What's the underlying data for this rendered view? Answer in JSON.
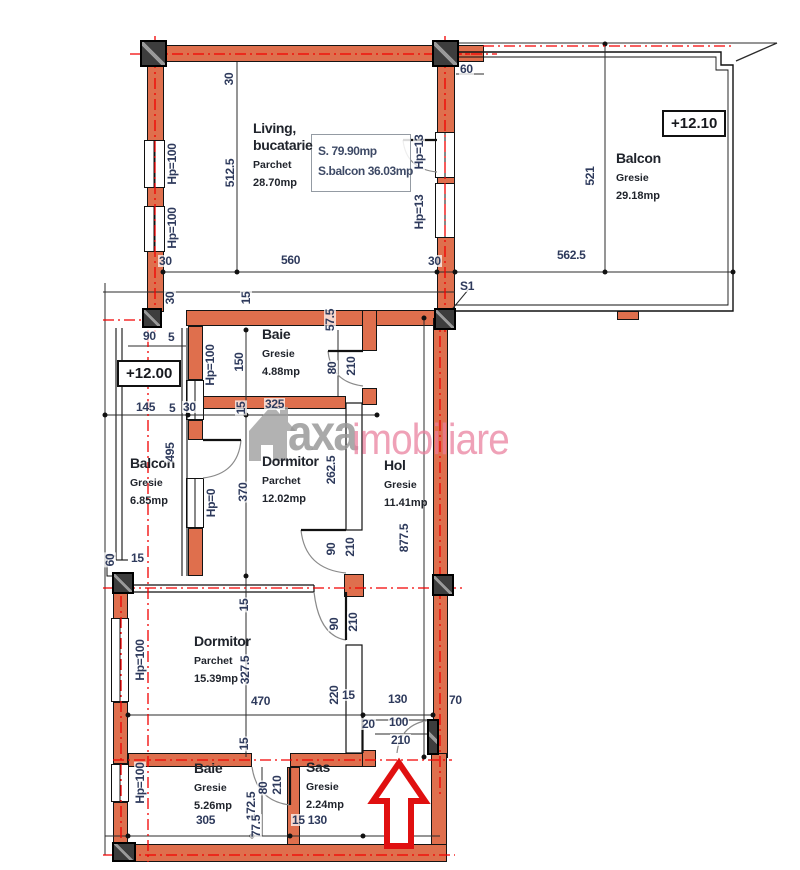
{
  "plan": {
    "watermark": {
      "brand_prefix": "axa",
      "brand_suffix": "imobiliare"
    },
    "info_box": {
      "line1": "S. 79.90mp",
      "line2": "S.balcon 36.03mp"
    },
    "level_markers": [
      {
        "text": "+12.00",
        "x": 117,
        "y": 360
      },
      {
        "text": "+12.10",
        "x": 662,
        "y": 110
      }
    ],
    "rooms": [
      {
        "id": "living",
        "name": "Living,",
        "name2": "bucatarie",
        "floor": "Parchet",
        "area": "28.70mp",
        "x": 253,
        "y": 120
      },
      {
        "id": "balcon-top",
        "name": "Balcon",
        "floor": "Gresie",
        "area": "29.18mp",
        "x": 616,
        "y": 150
      },
      {
        "id": "baie-1",
        "name": "Baie",
        "floor": "Gresie",
        "area": "4.88mp",
        "x": 262,
        "y": 326
      },
      {
        "id": "balcon-left",
        "name": "Balcon",
        "floor": "Gresie",
        "area": "6.85mp",
        "x": 130,
        "y": 455
      },
      {
        "id": "dormitor-1",
        "name": "Dormitor",
        "floor": "Parchet",
        "area": "12.02mp",
        "x": 262,
        "y": 453
      },
      {
        "id": "hol",
        "name": "Hol",
        "floor": "Gresie",
        "area": "11.41mp",
        "x": 384,
        "y": 457
      },
      {
        "id": "dormitor-2",
        "name": "Dormitor",
        "floor": "Parchet",
        "area": "15.39mp",
        "x": 194,
        "y": 633
      },
      {
        "id": "baie-2",
        "name": "Baie",
        "floor": "Gresie",
        "area": "5.26mp",
        "x": 194,
        "y": 760
      },
      {
        "id": "sas",
        "name": "Sas",
        "floor": "Gresie",
        "area": "2.24mp",
        "x": 306,
        "y": 759
      }
    ],
    "dimensions": [
      {
        "t": "30",
        "x": 229,
        "y": 79,
        "r": 1
      },
      {
        "t": "512.5",
        "x": 230,
        "y": 173,
        "r": 1
      },
      {
        "t": "Hp=100",
        "x": 172,
        "y": 164,
        "r": 1
      },
      {
        "t": "Hp=100",
        "x": 172,
        "y": 228,
        "r": 1
      },
      {
        "t": "Hp=13",
        "x": 419,
        "y": 152,
        "r": 1
      },
      {
        "t": "Hp=13",
        "x": 419,
        "y": 212,
        "r": 1
      },
      {
        "t": "30",
        "x": 158,
        "y": 255
      },
      {
        "t": "560",
        "x": 280,
        "y": 254
      },
      {
        "t": "30",
        "x": 427,
        "y": 255
      },
      {
        "t": "60",
        "x": 459,
        "y": 63
      },
      {
        "t": "521",
        "x": 590,
        "y": 176,
        "r": 1
      },
      {
        "t": "562.5",
        "x": 556,
        "y": 249
      },
      {
        "t": "S1",
        "x": 459,
        "y": 280
      },
      {
        "t": "30",
        "x": 170,
        "y": 298,
        "r": 1
      },
      {
        "t": "15",
        "x": 246,
        "y": 298,
        "r": 1
      },
      {
        "t": "90",
        "x": 142,
        "y": 330
      },
      {
        "t": "5",
        "x": 167,
        "y": 331
      },
      {
        "t": "145",
        "x": 135,
        "y": 401
      },
      {
        "t": "5",
        "x": 168,
        "y": 402
      },
      {
        "t": "30",
        "x": 182,
        "y": 401
      },
      {
        "t": "495",
        "x": 170,
        "y": 452,
        "r": 1
      },
      {
        "t": "60",
        "x": 110,
        "y": 560,
        "r": 1
      },
      {
        "t": "15",
        "x": 130,
        "y": 552
      },
      {
        "t": "Hp=0",
        "x": 211,
        "y": 503,
        "r": 1
      },
      {
        "t": "Hp=100",
        "x": 210,
        "y": 365,
        "r": 1
      },
      {
        "t": "150",
        "x": 239,
        "y": 362,
        "r": 1
      },
      {
        "t": "57.5",
        "x": 330,
        "y": 320,
        "r": 1
      },
      {
        "t": "80",
        "x": 332,
        "y": 368,
        "r": 1
      },
      {
        "t": "210",
        "x": 351,
        "y": 366,
        "r": 1
      },
      {
        "t": "15",
        "x": 241,
        "y": 408,
        "r": 1
      },
      {
        "t": "325",
        "x": 264,
        "y": 398
      },
      {
        "t": "370",
        "x": 243,
        "y": 492,
        "r": 1
      },
      {
        "t": "262.5",
        "x": 331,
        "y": 470,
        "r": 1
      },
      {
        "t": "90",
        "x": 331,
        "y": 549,
        "r": 1
      },
      {
        "t": "210",
        "x": 350,
        "y": 547,
        "r": 1
      },
      {
        "t": "877.5",
        "x": 404,
        "y": 538,
        "r": 1
      },
      {
        "t": "Hp=100",
        "x": 140,
        "y": 660,
        "r": 1
      },
      {
        "t": "Hp=100",
        "x": 140,
        "y": 783,
        "r": 1
      },
      {
        "t": "15",
        "x": 244,
        "y": 605,
        "r": 1
      },
      {
        "t": "327.5",
        "x": 245,
        "y": 670,
        "r": 1
      },
      {
        "t": "470",
        "x": 250,
        "y": 695
      },
      {
        "t": "90",
        "x": 334,
        "y": 624,
        "r": 1
      },
      {
        "t": "210",
        "x": 353,
        "y": 622,
        "r": 1
      },
      {
        "t": "220",
        "x": 334,
        "y": 695,
        "r": 1
      },
      {
        "t": "15",
        "x": 341,
        "y": 689
      },
      {
        "t": "15",
        "x": 244,
        "y": 744,
        "r": 1
      },
      {
        "t": "20",
        "x": 361,
        "y": 718
      },
      {
        "t": "130",
        "x": 387,
        "y": 693
      },
      {
        "t": "100",
        "x": 388,
        "y": 716
      },
      {
        "t": "210",
        "x": 390,
        "y": 734
      },
      {
        "t": "70",
        "x": 448,
        "y": 694
      },
      {
        "t": "172.5",
        "x": 251,
        "y": 806,
        "r": 1
      },
      {
        "t": "80",
        "x": 263,
        "y": 788,
        "r": 1
      },
      {
        "t": "210",
        "x": 277,
        "y": 785,
        "r": 1
      },
      {
        "t": "77.5",
        "x": 256,
        "y": 826,
        "r": 1
      },
      {
        "t": "305",
        "x": 195,
        "y": 814
      },
      {
        "t": "15 130",
        "x": 291,
        "y": 814
      }
    ],
    "colors": {
      "wall_fill": "#DF6F4D",
      "centerline_red": "#F20000",
      "dimension_text": "#2E3A5C",
      "watermark_gray": "#9F9F9F",
      "watermark_pink": "#EC87A0",
      "arrow_red": "#E01010"
    }
  }
}
